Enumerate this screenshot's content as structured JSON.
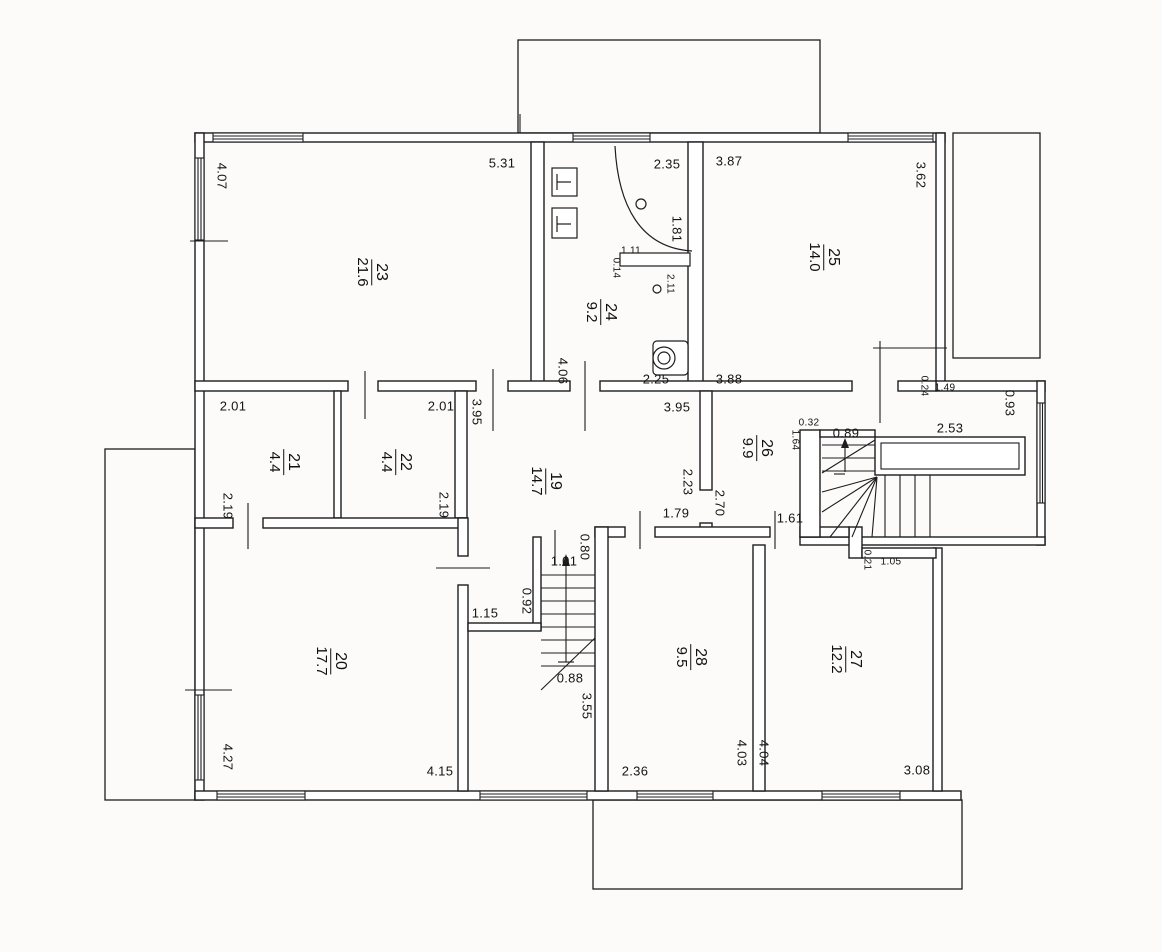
{
  "drawing": {
    "type": "apartment floor plan (scanned technical drawing)",
    "colors": {
      "line": "#1d1d1f",
      "paper": "#fcfbf9",
      "text": "#141414"
    }
  },
  "rooms": [
    {
      "number": "23",
      "area": "21.6",
      "x": 372,
      "y": 272
    },
    {
      "number": "24",
      "area": "9.2",
      "x": 601,
      "y": 312
    },
    {
      "number": "25",
      "area": "14.0",
      "x": 824,
      "y": 257
    },
    {
      "number": "21",
      "area": "4.4",
      "x": 284,
      "y": 462
    },
    {
      "number": "22",
      "area": "4.4",
      "x": 396,
      "y": 462
    },
    {
      "number": "19",
      "area": "14.7",
      "x": 546,
      "y": 481
    },
    {
      "number": "26",
      "area": "9.9",
      "x": 757,
      "y": 448
    },
    {
      "number": "20",
      "area": "17.7",
      "x": 331,
      "y": 661
    },
    {
      "number": "28",
      "area": "9.5",
      "x": 691,
      "y": 657
    },
    {
      "number": "27",
      "area": "12.2",
      "x": 846,
      "y": 659
    }
  ],
  "dims": [
    {
      "text": "4.07",
      "x": 222,
      "y": 176,
      "dir": "v",
      "small": false
    },
    {
      "text": "5.31",
      "x": 502,
      "y": 163,
      "dir": "h",
      "small": false
    },
    {
      "text": "2.35",
      "x": 667,
      "y": 164,
      "dir": "h",
      "small": false
    },
    {
      "text": "3.87",
      "x": 729,
      "y": 161,
      "dir": "h",
      "small": false
    },
    {
      "text": "3.62",
      "x": 921,
      "y": 175,
      "dir": "v",
      "small": false
    },
    {
      "text": "1.81",
      "x": 677,
      "y": 229,
      "dir": "v",
      "small": false
    },
    {
      "text": "1.11",
      "x": 631,
      "y": 251,
      "dir": "h",
      "small": true
    },
    {
      "text": "0.14",
      "x": 616,
      "y": 268,
      "dir": "v",
      "small": true
    },
    {
      "text": "2.11",
      "x": 670,
      "y": 284,
      "dir": "v",
      "small": true
    },
    {
      "text": "2.25",
      "x": 656,
      "y": 379,
      "dir": "h",
      "small": false
    },
    {
      "text": "3.88",
      "x": 729,
      "y": 379,
      "dir": "h",
      "small": false
    },
    {
      "text": "4.06",
      "x": 563,
      "y": 371,
      "dir": "v",
      "small": false
    },
    {
      "text": "0.24",
      "x": 924,
      "y": 386,
      "dir": "v",
      "small": true
    },
    {
      "text": "1.49",
      "x": 945,
      "y": 388,
      "dir": "h",
      "small": true
    },
    {
      "text": "0.93",
      "x": 1010,
      "y": 403,
      "dir": "v",
      "small": false
    },
    {
      "text": "2.01",
      "x": 233,
      "y": 406,
      "dir": "h",
      "small": false
    },
    {
      "text": "2.01",
      "x": 441,
      "y": 406,
      "dir": "h",
      "small": false
    },
    {
      "text": "3.95",
      "x": 477,
      "y": 412,
      "dir": "v",
      "small": false
    },
    {
      "text": "3.95",
      "x": 677,
      "y": 407,
      "dir": "h",
      "small": false
    },
    {
      "text": "0.32",
      "x": 809,
      "y": 423,
      "dir": "h",
      "small": true
    },
    {
      "text": "1.64",
      "x": 795,
      "y": 440,
      "dir": "v",
      "small": true
    },
    {
      "text": "0.89",
      "x": 846,
      "y": 433,
      "dir": "h",
      "small": false
    },
    {
      "text": "2.53",
      "x": 950,
      "y": 428,
      "dir": "h",
      "small": false
    },
    {
      "text": "2.19",
      "x": 228,
      "y": 506,
      "dir": "v",
      "small": false
    },
    {
      "text": "2.19",
      "x": 444,
      "y": 505,
      "dir": "v",
      "small": false
    },
    {
      "text": "2.23",
      "x": 688,
      "y": 482,
      "dir": "v",
      "small": false
    },
    {
      "text": "2.70",
      "x": 720,
      "y": 503,
      "dir": "v",
      "small": false
    },
    {
      "text": "1.79",
      "x": 676,
      "y": 513,
      "dir": "h",
      "small": false
    },
    {
      "text": "1.61",
      "x": 790,
      "y": 518,
      "dir": "h",
      "small": false
    },
    {
      "text": "0.21",
      "x": 867,
      "y": 560,
      "dir": "v",
      "small": true
    },
    {
      "text": "1.05",
      "x": 891,
      "y": 562,
      "dir": "h",
      "small": true
    },
    {
      "text": "1.15",
      "x": 485,
      "y": 613,
      "dir": "h",
      "small": false
    },
    {
      "text": "0.92",
      "x": 527,
      "y": 601,
      "dir": "v",
      "small": false
    },
    {
      "text": "1.01",
      "x": 564,
      "y": 561,
      "dir": "h",
      "small": false
    },
    {
      "text": "0.80",
      "x": 585,
      "y": 547,
      "dir": "v",
      "small": false
    },
    {
      "text": "0.88",
      "x": 570,
      "y": 678,
      "dir": "h",
      "small": false
    },
    {
      "text": "3.55",
      "x": 587,
      "y": 706,
      "dir": "v",
      "small": false
    },
    {
      "text": "4.27",
      "x": 228,
      "y": 757,
      "dir": "v",
      "small": false
    },
    {
      "text": "4.15",
      "x": 440,
      "y": 771,
      "dir": "h",
      "small": false
    },
    {
      "text": "2.36",
      "x": 635,
      "y": 771,
      "dir": "h",
      "small": false
    },
    {
      "text": "4.03",
      "x": 742,
      "y": 753,
      "dir": "v",
      "small": false
    },
    {
      "text": "4.04",
      "x": 764,
      "y": 753,
      "dir": "v",
      "small": false
    },
    {
      "text": "3.08",
      "x": 917,
      "y": 770,
      "dir": "h",
      "small": false
    }
  ]
}
